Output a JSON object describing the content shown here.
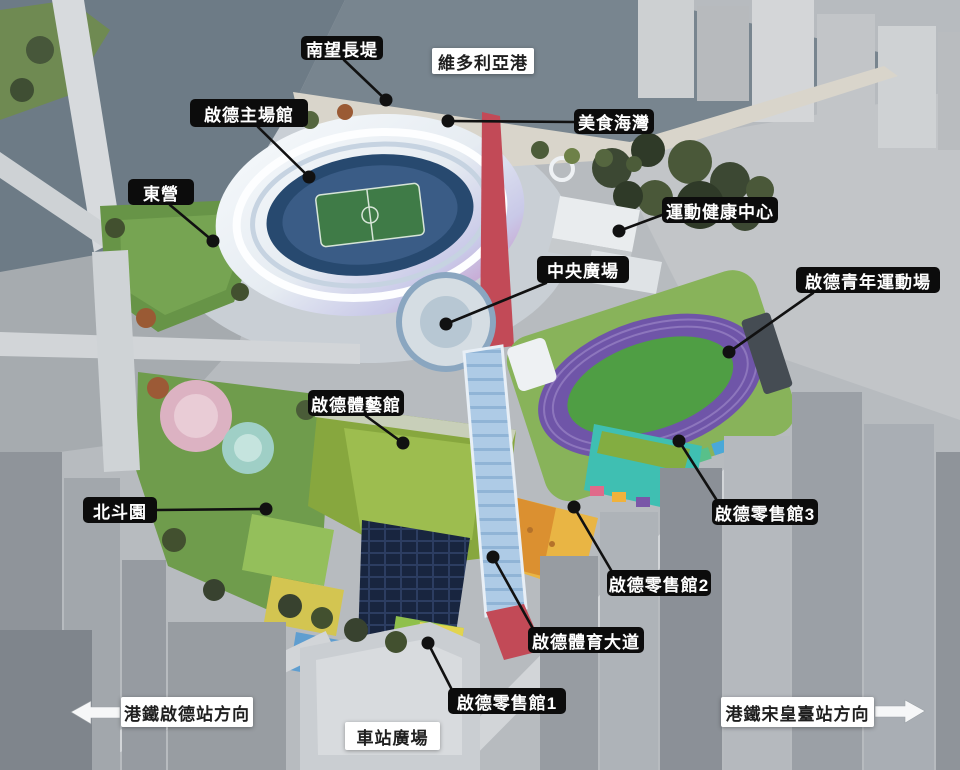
{
  "colors": {
    "label_bg": "#0c0c0c",
    "label_text": "#ffffff",
    "box_bg": "#ffffff",
    "box_text": "#1f1f1f",
    "leader": "#111111",
    "arrow": "#f6f7f8"
  },
  "scene_colors": {
    "harbour_water": "#78858f",
    "stadium_bowl": "#27496f",
    "pitch_green": "#3f7b47",
    "track_purple": "#6f55a8",
    "retail_teal": "#3fbfb2",
    "retail_yellow": "#e9b544",
    "avenue_red": "#c24a57",
    "lawn_green": "#679447",
    "canopy_blue": "#aecbe6"
  },
  "annotations": [
    {
      "name": "label-south-promenade",
      "text": "南望長堤",
      "style": "pill",
      "box": {
        "x": 301,
        "y": 36,
        "w": 82,
        "h": 24
      },
      "leader": {
        "x1": 344,
        "y1": 60,
        "x2": 386,
        "y2": 100
      }
    },
    {
      "name": "label-victoria-harbour",
      "text": "維多利亞港",
      "style": "box",
      "box": {
        "x": 432,
        "y": 48,
        "w": 102,
        "h": 26
      }
    },
    {
      "name": "label-main-stadium",
      "text": "啟德主場館",
      "style": "pill",
      "box": {
        "x": 190,
        "y": 99,
        "w": 118,
        "h": 28
      },
      "leader": {
        "x1": 258,
        "y1": 127,
        "x2": 309,
        "y2": 177
      }
    },
    {
      "name": "label-east-camp",
      "text": "東營",
      "style": "pill",
      "box": {
        "x": 128,
        "y": 179,
        "w": 66,
        "h": 26
      },
      "leader": {
        "x1": 170,
        "y1": 205,
        "x2": 213,
        "y2": 241
      }
    },
    {
      "name": "label-dining-cove",
      "text": "美食海灣",
      "style": "pill",
      "box": {
        "x": 574,
        "y": 109,
        "w": 80,
        "h": 25
      },
      "leader": {
        "x1": 574,
        "y1": 122,
        "x2": 448,
        "y2": 121
      }
    },
    {
      "name": "label-wellness-centre",
      "text": "運動健康中心",
      "style": "pill",
      "box": {
        "x": 662,
        "y": 197,
        "w": 116,
        "h": 26
      },
      "leader": {
        "x1": 662,
        "y1": 215,
        "x2": 619,
        "y2": 231
      }
    },
    {
      "name": "label-central-square",
      "text": "中央廣場",
      "style": "pill",
      "box": {
        "x": 537,
        "y": 256,
        "w": 92,
        "h": 27
      },
      "leader": {
        "x1": 546,
        "y1": 283,
        "x2": 446,
        "y2": 324
      }
    },
    {
      "name": "label-youth-sports-ground",
      "text": "啟德青年運動場",
      "style": "pill",
      "box": {
        "x": 796,
        "y": 267,
        "w": 144,
        "h": 26
      },
      "leader": {
        "x1": 813,
        "y1": 293,
        "x2": 729,
        "y2": 352
      }
    },
    {
      "name": "label-indoor-sports-centre",
      "text": "啟德體藝館",
      "style": "pill",
      "box": {
        "x": 308,
        "y": 390,
        "w": 96,
        "h": 26
      },
      "leader": {
        "x1": 366,
        "y1": 416,
        "x2": 403,
        "y2": 443
      }
    },
    {
      "name": "label-north-dipper-garden",
      "text": "北斗園",
      "style": "pill",
      "box": {
        "x": 83,
        "y": 497,
        "w": 74,
        "h": 26
      },
      "leader": {
        "x1": 157,
        "y1": 510,
        "x2": 266,
        "y2": 509
      }
    },
    {
      "name": "label-retail-hall-3",
      "text": "啟德零售館3",
      "style": "pill",
      "box": {
        "x": 712,
        "y": 499,
        "w": 106,
        "h": 26
      },
      "leader": {
        "x1": 716,
        "y1": 499,
        "x2": 679,
        "y2": 441
      }
    },
    {
      "name": "label-retail-hall-2",
      "text": "啟德零售館2",
      "style": "pill",
      "box": {
        "x": 607,
        "y": 570,
        "w": 104,
        "h": 26
      },
      "leader": {
        "x1": 611,
        "y1": 570,
        "x2": 574,
        "y2": 507
      }
    },
    {
      "name": "label-sports-avenue",
      "text": "啟德體育大道",
      "style": "pill",
      "box": {
        "x": 528,
        "y": 627,
        "w": 116,
        "h": 26
      },
      "leader": {
        "x1": 532,
        "y1": 627,
        "x2": 493,
        "y2": 557
      }
    },
    {
      "name": "label-retail-hall-1",
      "text": "啟德零售館1",
      "style": "pill",
      "box": {
        "x": 448,
        "y": 688,
        "w": 118,
        "h": 26
      },
      "leader": {
        "x1": 451,
        "y1": 688,
        "x2": 428,
        "y2": 643
      }
    },
    {
      "name": "label-station-square",
      "text": "車站廣場",
      "style": "box",
      "box": {
        "x": 345,
        "y": 722,
        "w": 95,
        "h": 28
      }
    },
    {
      "name": "label-mtr-kai-tak-direction",
      "text": "港鐵啟德站方向",
      "style": "box",
      "box": {
        "x": 121,
        "y": 697,
        "w": 132,
        "h": 30
      },
      "arrow": {
        "dir": "left",
        "tip_x": 71,
        "from_x": 120,
        "y": 712
      }
    },
    {
      "name": "label-mtr-sung-wong-toi-direction",
      "text": "港鐵宋皇臺站方向",
      "style": "box",
      "box": {
        "x": 721,
        "y": 697,
        "w": 153,
        "h": 30
      },
      "arrow": {
        "dir": "right",
        "tip_x": 925,
        "from_x": 875,
        "y": 711
      }
    }
  ]
}
